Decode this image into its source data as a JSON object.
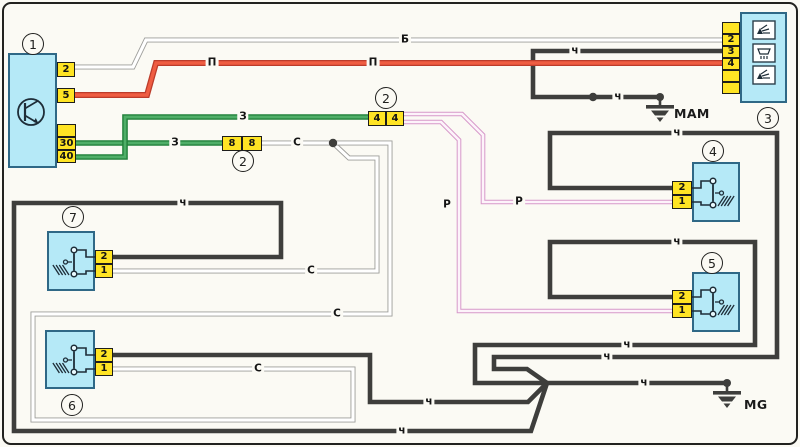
{
  "title": "washer-wiper-wiring-diagram",
  "palette": {
    "paper": "#fbfaf4",
    "frame": "#22221f",
    "box_fill": "#b5e9f7",
    "box_border": "#2f6886",
    "terminal_fill": "#ffe424",
    "terminal_border": "#1d1d1b",
    "wire_black": "#3e3e3c",
    "wire_white_edge": "#9d9d9a",
    "wire_white_fill": "#ffffff",
    "wire_red_edge": "#bc3c2b",
    "wire_red_fill": "#ef5d42",
    "wire_green_edge": "#20803a",
    "wire_green_fill": "#4fae68",
    "wire_pink_edge": "#d698c9",
    "wire_pink_fill": "#fdf3fa",
    "symbol_line": "#1e2d38",
    "text": "#161616"
  },
  "components": [
    {
      "id": "1",
      "circle_label": "1",
      "circle_x": 33,
      "circle_y": 44,
      "box": [
        8,
        53,
        49,
        115
      ],
      "symbol": "transistor",
      "terminal_side": "right",
      "terminals": [
        {
          "label": "2",
          "x": 57,
          "y": 62,
          "w": 18,
          "h": 15
        },
        {
          "label": "5",
          "x": 57,
          "y": 88,
          "w": 18,
          "h": 15
        },
        {
          "label": "",
          "x": 57,
          "y": 124,
          "w": 19,
          "h": 13
        },
        {
          "label": "30",
          "x": 57,
          "y": 137,
          "w": 19,
          "h": 13
        },
        {
          "label": "40",
          "x": 57,
          "y": 150,
          "w": 19,
          "h": 13
        }
      ]
    },
    {
      "id": "3",
      "circle_label": "3",
      "circle_x": 768,
      "circle_y": 118,
      "box": [
        740,
        12,
        47,
        91
      ],
      "symbol": "washer-icons",
      "terminal_side": "left",
      "terminals": [
        {
          "label": "",
          "x": 722,
          "y": 22,
          "w": 18,
          "h": 12
        },
        {
          "label": "2",
          "x": 722,
          "y": 34,
          "w": 18,
          "h": 12
        },
        {
          "label": "3",
          "x": 722,
          "y": 46,
          "w": 18,
          "h": 12
        },
        {
          "label": "4",
          "x": 722,
          "y": 58,
          "w": 18,
          "h": 12
        },
        {
          "label": "",
          "x": 722,
          "y": 70,
          "w": 18,
          "h": 12
        },
        {
          "label": "",
          "x": 722,
          "y": 82,
          "w": 18,
          "h": 12
        }
      ]
    },
    {
      "id": "4",
      "circle_label": "4",
      "circle_x": 713,
      "circle_y": 151,
      "box": [
        692,
        162,
        48,
        60
      ],
      "symbol": "switch-right",
      "terminal_side": "left",
      "terminals": [
        {
          "label": "2",
          "x": 672,
          "y": 181,
          "w": 20,
          "h": 14
        },
        {
          "label": "1",
          "x": 672,
          "y": 195,
          "w": 20,
          "h": 14
        }
      ]
    },
    {
      "id": "5",
      "circle_label": "5",
      "circle_x": 712,
      "circle_y": 263,
      "box": [
        692,
        272,
        48,
        60
      ],
      "symbol": "switch-right",
      "terminal_side": "left",
      "terminals": [
        {
          "label": "2",
          "x": 672,
          "y": 290,
          "w": 20,
          "h": 14
        },
        {
          "label": "1",
          "x": 672,
          "y": 304,
          "w": 20,
          "h": 14
        }
      ]
    },
    {
      "id": "7",
      "circle_label": "7",
      "circle_x": 73,
      "circle_y": 217,
      "box": [
        47,
        231,
        48,
        60
      ],
      "symbol": "switch-left",
      "terminal_side": "right",
      "terminals": [
        {
          "label": "2",
          "x": 95,
          "y": 250,
          "w": 18,
          "h": 14
        },
        {
          "label": "1",
          "x": 95,
          "y": 264,
          "w": 18,
          "h": 14
        }
      ]
    },
    {
      "id": "6",
      "circle_label": "6",
      "circle_x": 72,
      "circle_y": 405,
      "box": [
        45,
        330,
        50,
        59
      ],
      "symbol": "switch-left",
      "terminal_side": "right",
      "terminals": [
        {
          "label": "2",
          "x": 95,
          "y": 348,
          "w": 18,
          "h": 14
        },
        {
          "label": "1",
          "x": 95,
          "y": 362,
          "w": 18,
          "h": 14
        }
      ]
    }
  ],
  "connectors": [
    {
      "id": "2a",
      "circle_label": "2",
      "circle_x": 386,
      "circle_y": 98,
      "cells": [
        {
          "label": "4",
          "x": 368,
          "y": 111,
          "w": 18,
          "h": 15
        },
        {
          "label": "4",
          "x": 386,
          "y": 111,
          "w": 18,
          "h": 15
        }
      ]
    },
    {
      "id": "2b",
      "circle_label": "2",
      "circle_x": 243,
      "circle_y": 161,
      "cells": [
        {
          "label": "8",
          "x": 222,
          "y": 136,
          "w": 20,
          "h": 15
        },
        {
          "label": "8",
          "x": 242,
          "y": 136,
          "w": 20,
          "h": 15
        }
      ]
    }
  ],
  "wires": [
    {
      "id": "black-mam",
      "color": "black",
      "points": [
        [
          723,
          51
        ],
        [
          533,
          51
        ],
        [
          533,
          97
        ],
        [
          660,
          97
        ]
      ]
    },
    {
      "id": "black-4-loop",
      "color": "black",
      "points": [
        [
          673,
          188
        ],
        [
          550,
          188
        ],
        [
          550,
          133
        ],
        [
          777,
          133
        ],
        [
          777,
          357
        ],
        [
          494,
          357
        ],
        [
          494,
          369
        ],
        [
          527,
          369
        ],
        [
          547,
          383
        ]
      ]
    },
    {
      "id": "black-5-loop",
      "color": "black",
      "points": [
        [
          673,
          297
        ],
        [
          550,
          297
        ],
        [
          550,
          242
        ],
        [
          755,
          242
        ],
        [
          755,
          345
        ],
        [
          475,
          345
        ],
        [
          475,
          383
        ],
        [
          548,
          383
        ]
      ]
    },
    {
      "id": "black-mg",
      "color": "black",
      "points": [
        [
          547,
          383
        ],
        [
          727,
          383
        ]
      ]
    },
    {
      "id": "black-6",
      "color": "black",
      "points": [
        [
          113,
          355
        ],
        [
          370,
          355
        ],
        [
          370,
          402
        ],
        [
          528,
          402
        ],
        [
          547,
          383
        ]
      ]
    },
    {
      "id": "black-7-loop",
      "color": "black",
      "points": [
        [
          113,
          257
        ],
        [
          281,
          257
        ],
        [
          281,
          203
        ],
        [
          14,
          203
        ],
        [
          14,
          431
        ],
        [
          531,
          431
        ],
        [
          547,
          383
        ]
      ]
    },
    {
      "id": "white-b",
      "color": "white",
      "points": [
        [
          75,
          67
        ],
        [
          133,
          67
        ],
        [
          146,
          40
        ],
        [
          723,
          40
        ]
      ]
    },
    {
      "id": "white-7",
      "color": "white",
      "points": [
        [
          113,
          271
        ],
        [
          377,
          271
        ],
        [
          377,
          158
        ],
        [
          349,
          158
        ],
        [
          333,
          143
        ]
      ]
    },
    {
      "id": "white-6-loop",
      "color": "white",
      "points": [
        [
          113,
          369
        ],
        [
          353,
          369
        ],
        [
          353,
          420
        ],
        [
          33,
          420
        ],
        [
          33,
          314
        ],
        [
          390,
          314
        ],
        [
          390,
          143
        ],
        [
          333,
          143
        ]
      ]
    },
    {
      "id": "white-to-8",
      "color": "white",
      "points": [
        [
          333,
          143
        ],
        [
          262,
          143
        ]
      ]
    },
    {
      "id": "green-30",
      "color": "green",
      "points": [
        [
          75,
          143
        ],
        [
          222,
          143
        ]
      ]
    },
    {
      "id": "green-40",
      "color": "green",
      "points": [
        [
          75,
          157
        ],
        [
          125,
          157
        ],
        [
          125,
          117
        ],
        [
          368,
          117
        ]
      ]
    },
    {
      "id": "red-p",
      "color": "red",
      "points": [
        [
          75,
          95
        ],
        [
          147,
          95
        ],
        [
          156,
          63
        ],
        [
          723,
          63
        ]
      ]
    },
    {
      "id": "pink-4",
      "color": "pink",
      "points": [
        [
          404,
          114
        ],
        [
          462,
          114
        ],
        [
          483,
          135
        ],
        [
          483,
          202
        ],
        [
          673,
          202
        ]
      ]
    },
    {
      "id": "pink-5",
      "color": "pink",
      "points": [
        [
          404,
          122
        ],
        [
          441,
          122
        ],
        [
          459,
          140
        ],
        [
          459,
          311
        ],
        [
          673,
          311
        ]
      ]
    }
  ],
  "wire_labels": [
    {
      "text": "Б",
      "x": 405,
      "y": 40
    },
    {
      "text": "П",
      "x": 212,
      "y": 63
    },
    {
      "text": "П",
      "x": 373,
      "y": 63
    },
    {
      "text": "З",
      "x": 175,
      "y": 143
    },
    {
      "text": "З",
      "x": 243,
      "y": 117
    },
    {
      "text": "С",
      "x": 297,
      "y": 143
    },
    {
      "text": "С",
      "x": 311,
      "y": 271
    },
    {
      "text": "С",
      "x": 337,
      "y": 314
    },
    {
      "text": "С",
      "x": 258,
      "y": 369
    },
    {
      "text": "Р",
      "x": 519,
      "y": 202
    },
    {
      "text": "Р",
      "x": 447,
      "y": 205
    },
    {
      "text": "ч",
      "x": 575,
      "y": 51
    },
    {
      "text": "ч",
      "x": 618,
      "y": 97
    },
    {
      "text": "ч",
      "x": 677,
      "y": 133
    },
    {
      "text": "ч",
      "x": 677,
      "y": 242
    },
    {
      "text": "ч",
      "x": 627,
      "y": 345
    },
    {
      "text": "ч",
      "x": 607,
      "y": 357
    },
    {
      "text": "ч",
      "x": 644,
      "y": 383
    },
    {
      "text": "ч",
      "x": 183,
      "y": 203
    },
    {
      "text": "ч",
      "x": 402,
      "y": 431
    },
    {
      "text": "ч",
      "x": 429,
      "y": 402
    }
  ],
  "junction_dots": [
    [
      333,
      143
    ],
    [
      593,
      97
    ]
  ],
  "grounds": [
    {
      "label": "MAM",
      "x": 660,
      "y": 97,
      "label_dx": 14,
      "label_dy": 9
    },
    {
      "label": "MG",
      "x": 727,
      "y": 383,
      "label_dx": 17,
      "label_dy": 14
    }
  ]
}
